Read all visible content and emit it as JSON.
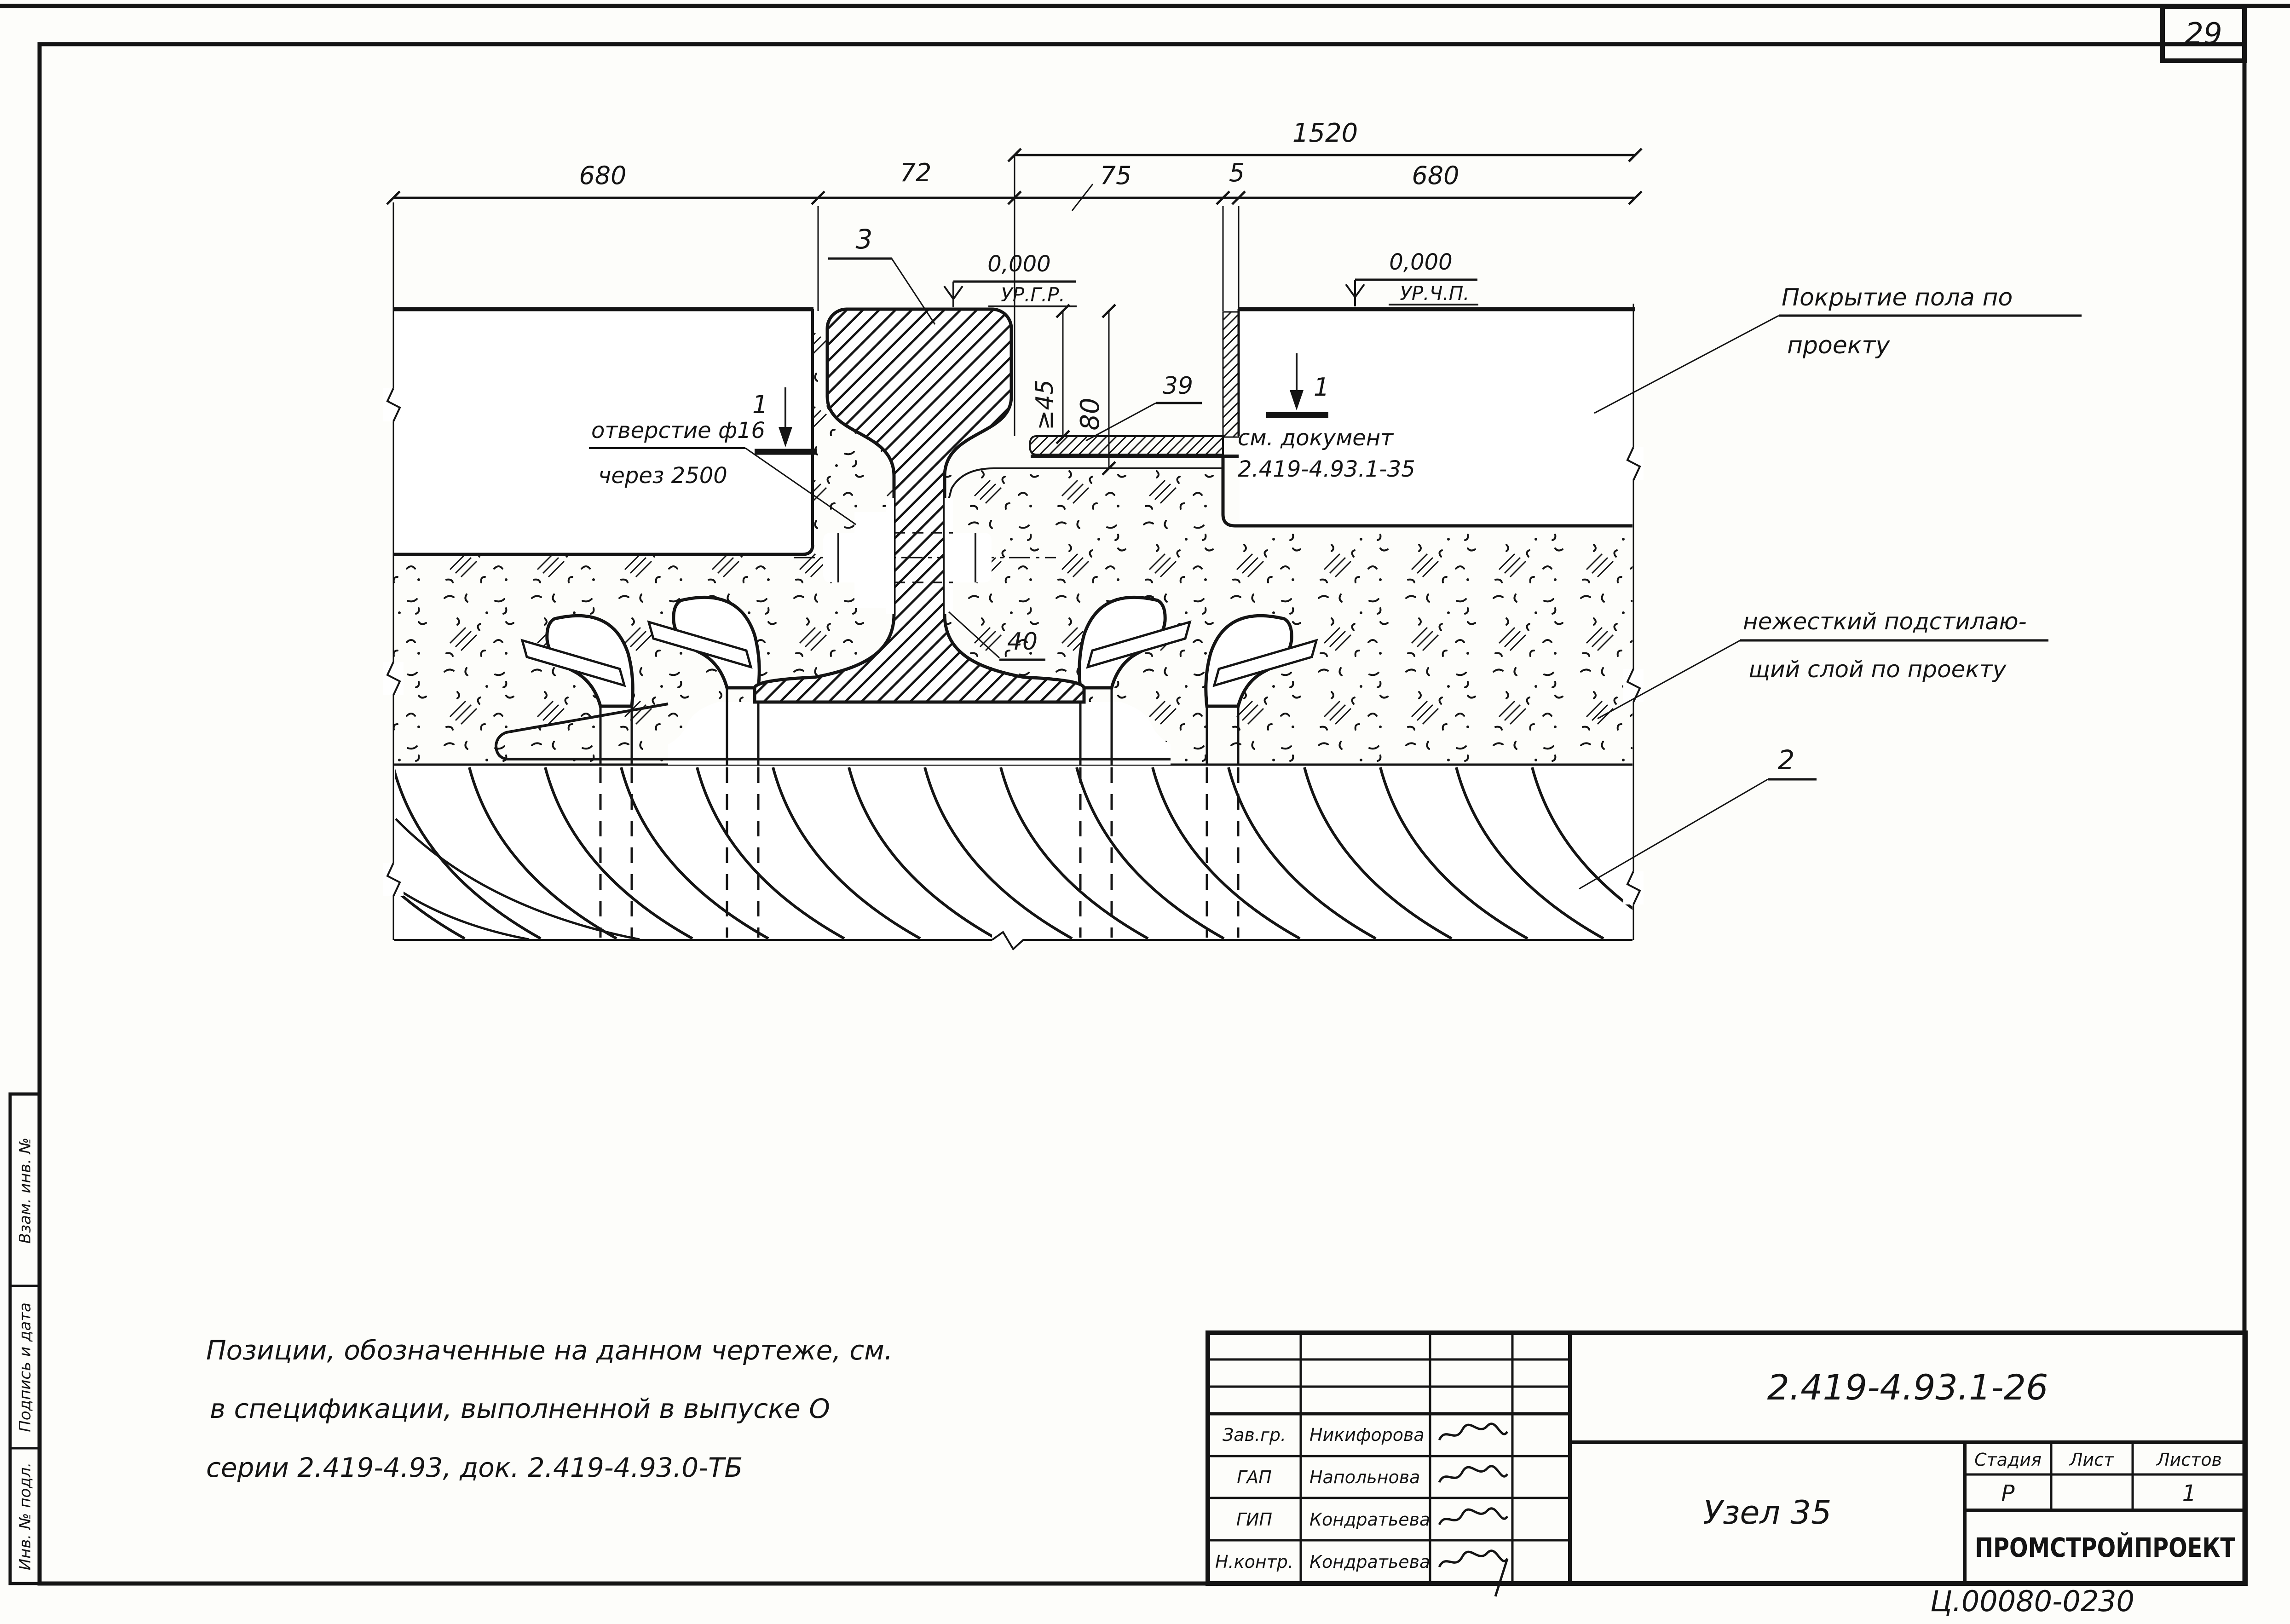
{
  "sheet": {
    "page_number": "29",
    "footer_code": "Ц.00080-02",
    "footer_num": "30",
    "footer_format": "Формат А3"
  },
  "side_column": {
    "top": "Взам. инв. №",
    "middle": "Подпись и дата",
    "bottom": "Инв. № подл."
  },
  "dimensions": {
    "gauge": "1520",
    "row": [
      "680",
      "72",
      "75",
      "5",
      "680"
    ],
    "vert_45": "≥45",
    "vert_80": "80"
  },
  "levels": {
    "left_value": "0,000",
    "left_label": "УР.Г.Р.",
    "right_value": "0,000",
    "right_label": "УР.Ч.П."
  },
  "callouts": {
    "pos3": "3",
    "section_mark_left": "1",
    "section_mark_right": "1",
    "pos39": "39",
    "pos40": "40",
    "pos2": "2",
    "hole_line1": "отверстие ф16",
    "hole_line2": "через 2500",
    "doc_line1": "см. документ",
    "doc_line2": "2.419-4.93.1-35",
    "floor_line1": "Покрытие пола по",
    "floor_line2": "проекту",
    "underlay_line1": "нежесткий  подстилаю-",
    "underlay_line2": "щий  слой по проекту"
  },
  "note": {
    "line1": "Позиции, обозначенные  на  данном  чертеже, см.",
    "line2": "в спецификации,  выполненной  в  выпуске О",
    "line3": "серии  2.419-4.93,  док. 2.419-4.93.0-ТБ"
  },
  "title_block": {
    "doc_number": "2.419-4.93.1-26",
    "title": "Узел 35",
    "stage_label": "Стадия",
    "sheet_label": "Лист",
    "sheets_label": "Листов",
    "stage": "Р",
    "sheet": "",
    "sheets": "1",
    "org": "ПРОМСТРОЙПРОЕКТ",
    "rows": [
      {
        "role": "Зав.гр.",
        "name": "Никифорова"
      },
      {
        "role": "ГАП",
        "name": "Напольнова"
      },
      {
        "role": "ГИП",
        "name": "Кондратьева"
      },
      {
        "role": "Н.контр.",
        "name": "Кондратьева"
      }
    ]
  }
}
